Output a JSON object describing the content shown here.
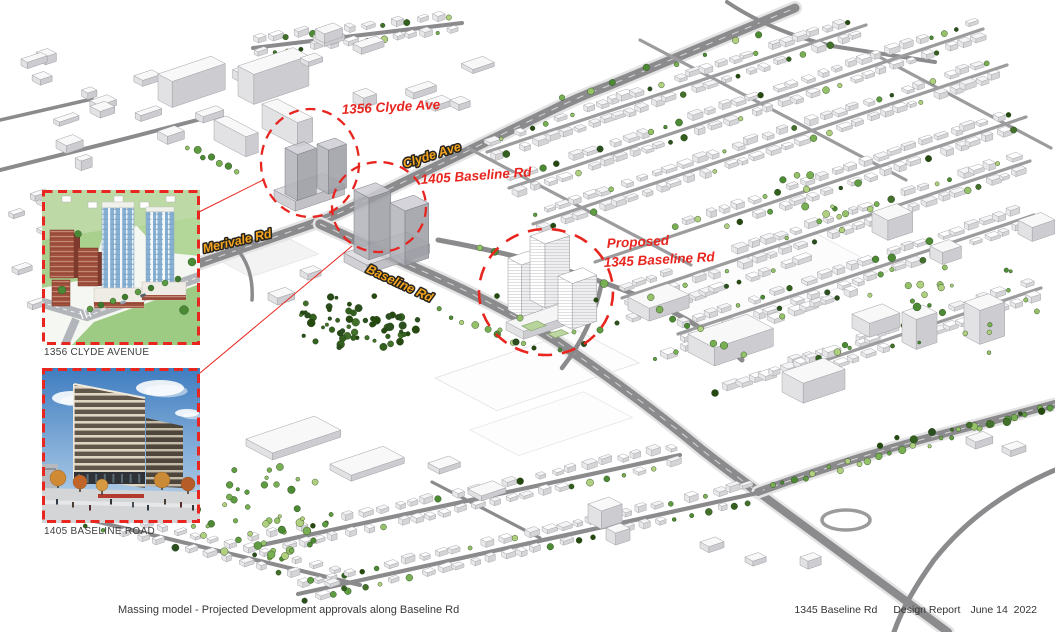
{
  "model": {
    "site_labels": [
      {
        "text": "1356 Clyde Ave"
      },
      {
        "text": "1405 Baseline Rd"
      },
      {
        "text_line1": "Proposed",
        "text_line2": "1345 Baseline Rd"
      }
    ],
    "road_labels": [
      {
        "text": "Clyde Ave"
      },
      {
        "text": "Merivale Rd"
      },
      {
        "text": "Baseline Rd"
      }
    ],
    "colors": {
      "highlight_red": "#e8251f",
      "road_label_orange": "#f6a51f",
      "building_white": "#f8f8f9",
      "road_gray": "#8b8b8d",
      "tree_green": "#4c8a33"
    }
  },
  "insets": [
    {
      "caption": "1356 CLYDE AVENUE"
    },
    {
      "caption": "1405 BASELINE ROAD"
    }
  ],
  "footer": {
    "caption": "Massing model - Projected Development approvals along Baseline Rd",
    "project": "1345 Baseline Rd",
    "doc_title": "Design Report",
    "date": "June 14  2022"
  }
}
